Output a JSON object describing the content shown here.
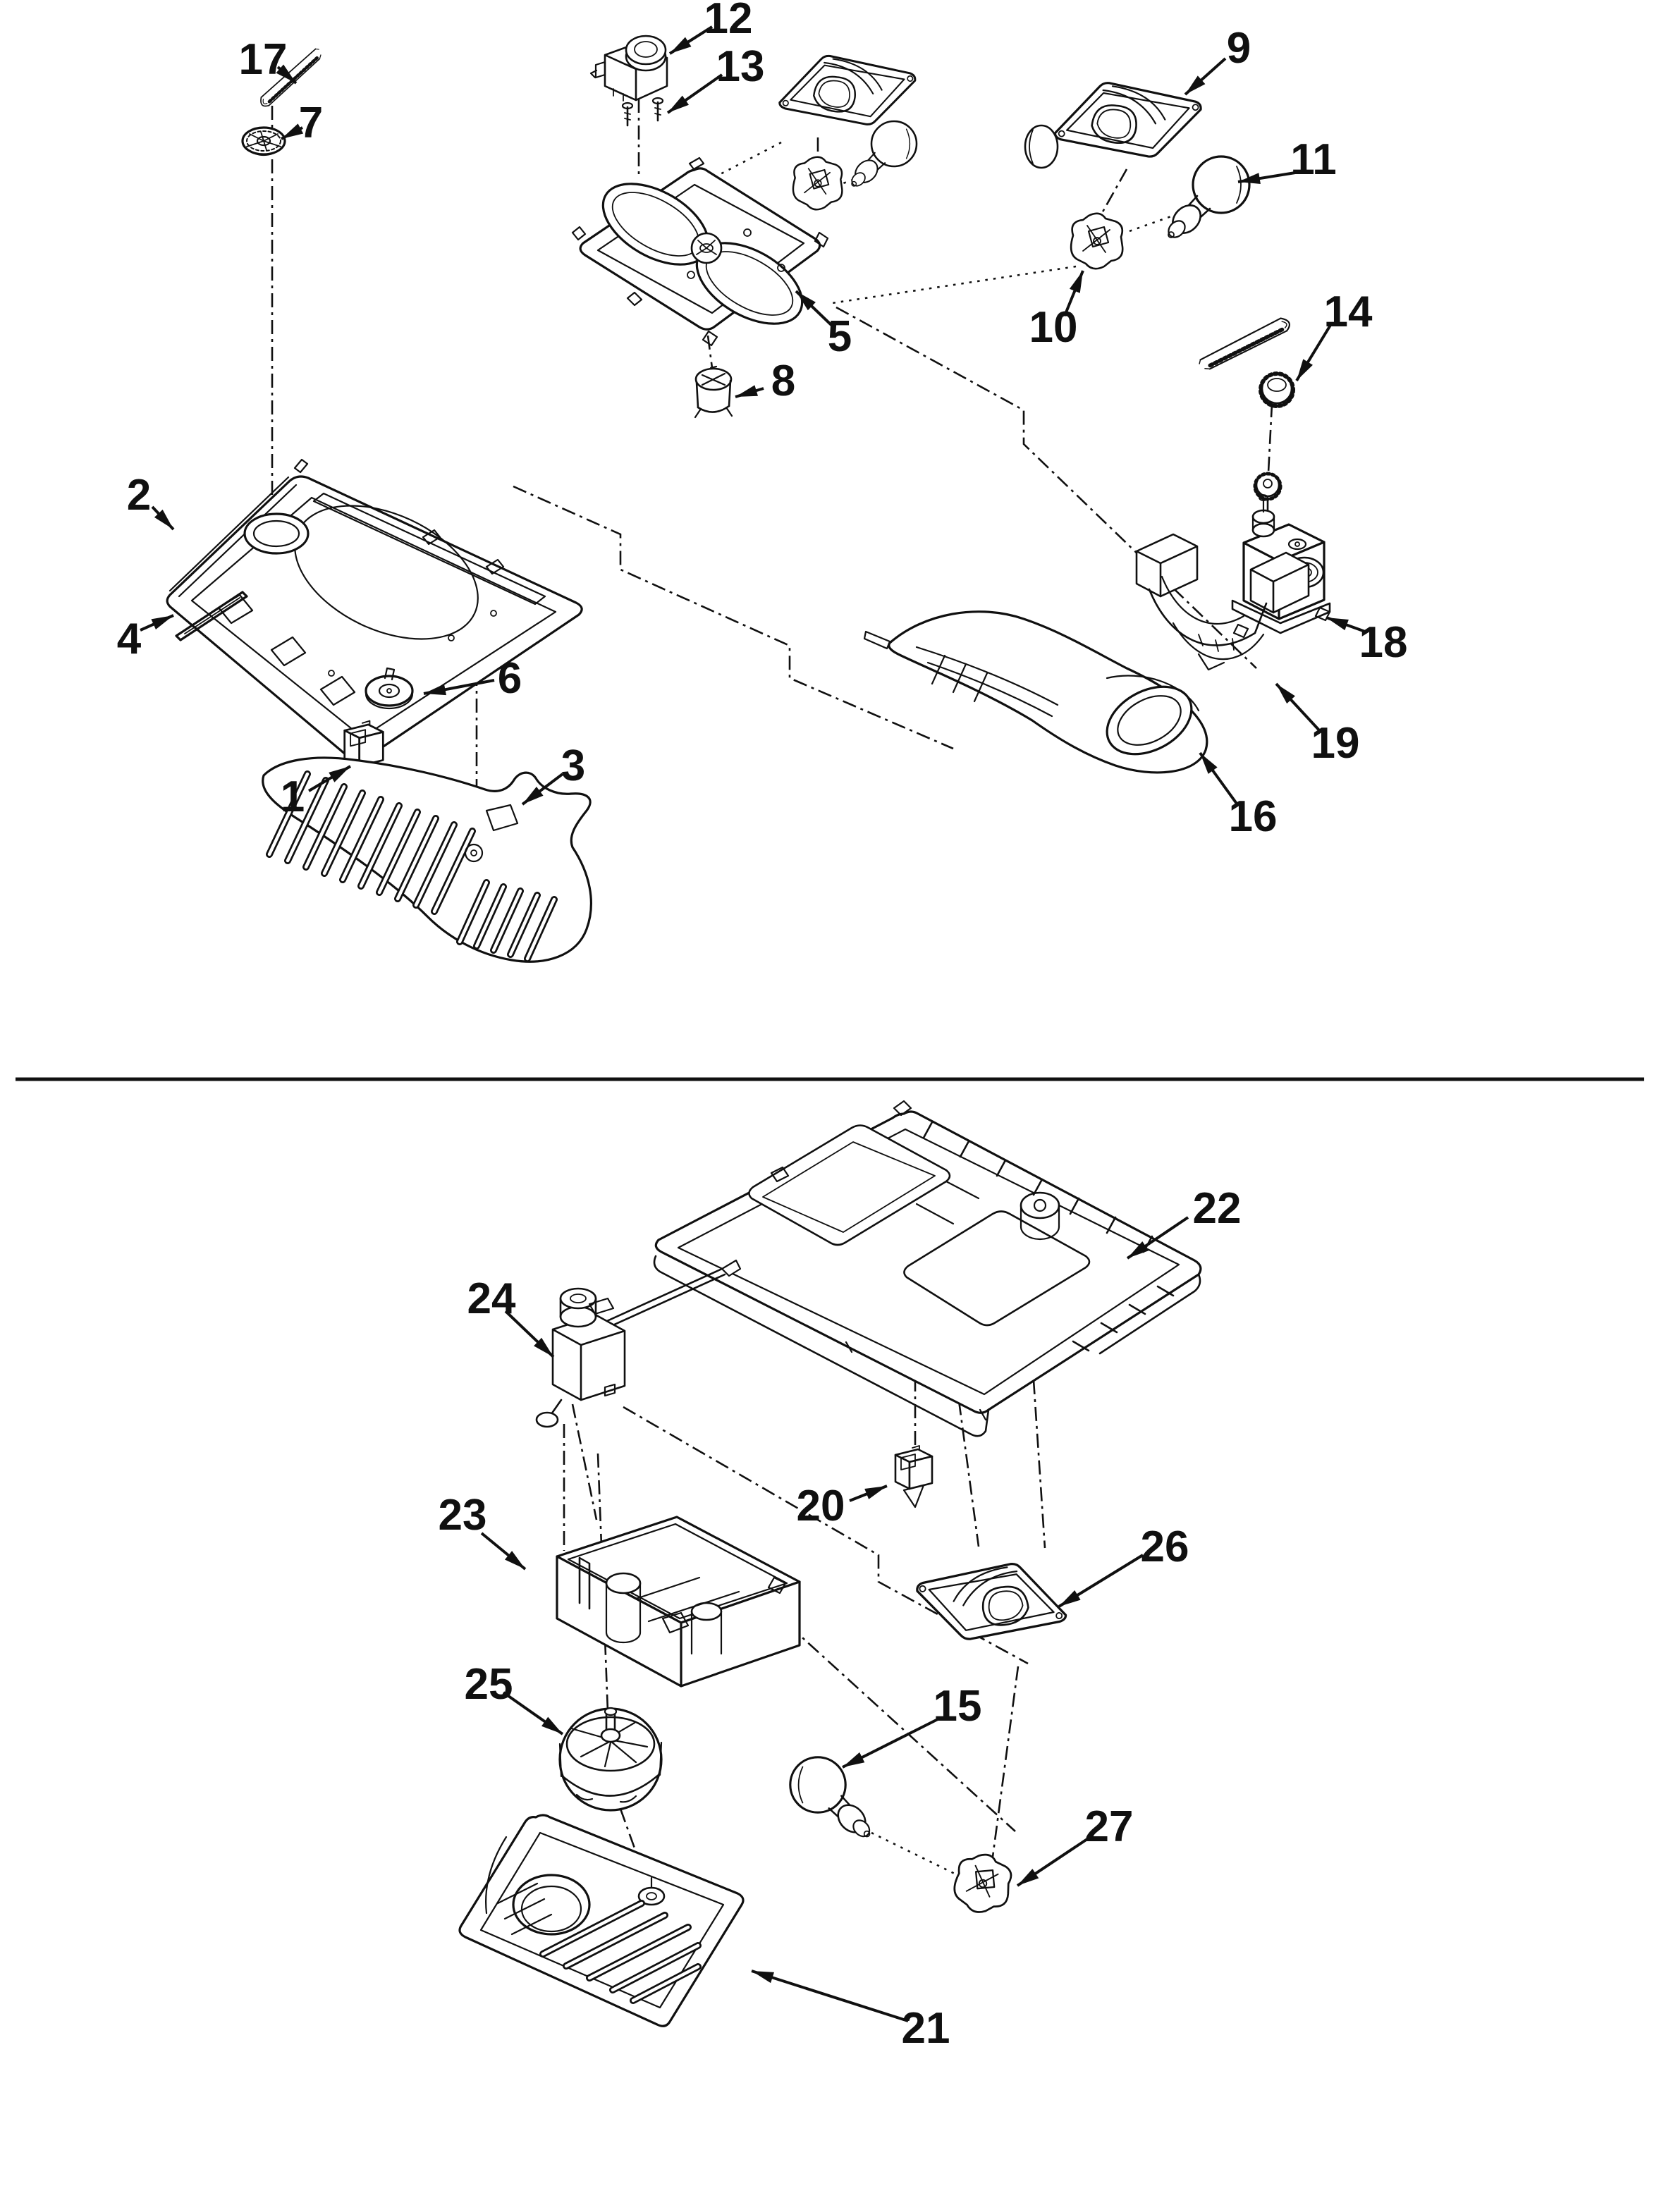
{
  "diagram": {
    "type": "exploded-parts-diagram",
    "ink_color": "#101010",
    "background_color": "#ffffff",
    "upper_section_callouts": [
      "1",
      "2",
      "3",
      "4",
      "5",
      "6",
      "7",
      "8",
      "9",
      "10",
      "11",
      "12",
      "13",
      "14",
      "16",
      "17",
      "18",
      "19"
    ],
    "lower_section_callouts": [
      "15",
      "20",
      "21",
      "22",
      "23",
      "24",
      "25",
      "26",
      "27"
    ],
    "labels": {
      "n1": "1",
      "n2": "2",
      "n3": "3",
      "n4": "4",
      "n5": "5",
      "n6": "6",
      "n7": "7",
      "n8": "8",
      "n9": "9",
      "n10": "10",
      "n11": "11",
      "n12": "12",
      "n13": "13",
      "n14": "14",
      "n15": "15",
      "n16": "16",
      "n17": "17",
      "n18": "18",
      "n19": "19",
      "n20": "20",
      "n21": "21",
      "n22": "22",
      "n23": "23",
      "n24": "24",
      "n25": "25",
      "n26": "26",
      "n27": "27"
    }
  }
}
